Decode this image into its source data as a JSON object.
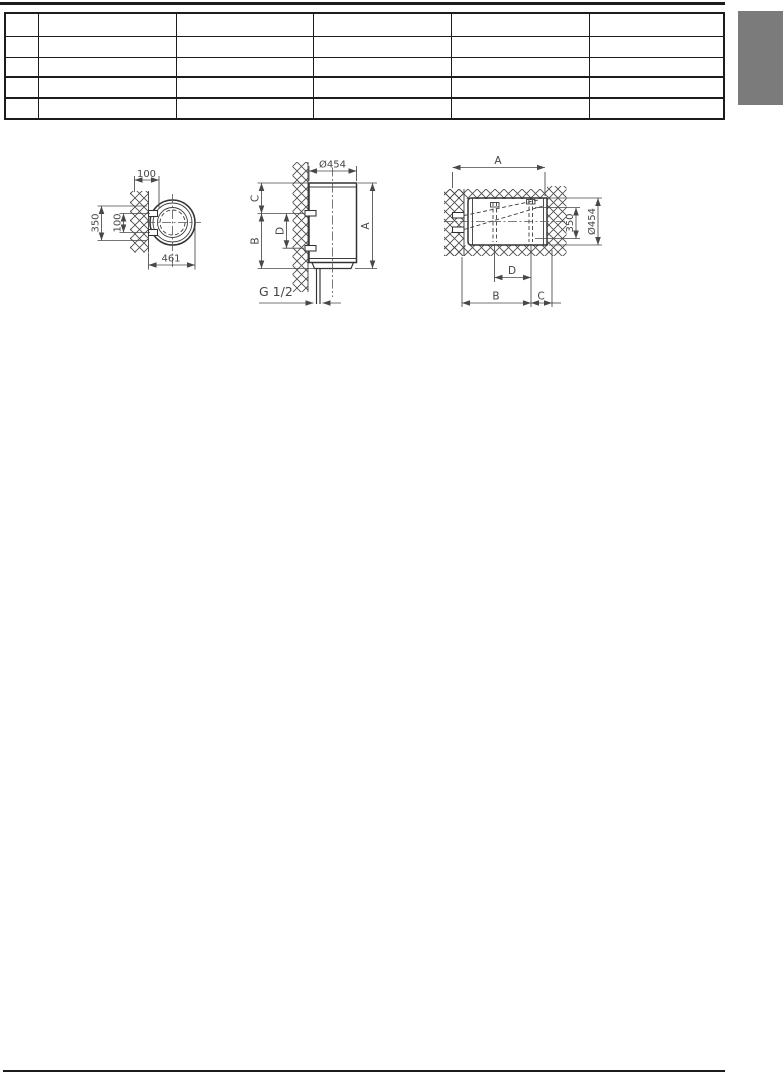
{
  "page": {
    "background": "#ffffff",
    "top_rule_color": "#1c1c1c",
    "bottom_rule_color": "#1c1c1c",
    "section_tab_color": "#7b7b7b"
  },
  "table": {
    "rows": 5,
    "cols": 6,
    "cells": [
      [
        "",
        "",
        "",
        "",
        "",
        ""
      ],
      [
        "",
        "",
        "",
        "",
        "",
        ""
      ],
      [
        "",
        "",
        "",
        "",
        "",
        ""
      ],
      [
        "",
        "",
        "",
        "",
        "",
        ""
      ],
      [
        "",
        "",
        "",
        "",
        "",
        ""
      ]
    ]
  },
  "drawings": {
    "top_view": {
      "dims": {
        "top": "100",
        "left_outer": "350",
        "left_inner": "100",
        "bottom": "461"
      }
    },
    "vertical_mount_view": {
      "dims": {
        "diameter_top": "Ø454",
        "height_right": "A",
        "left_top": "C",
        "left_bottom": "B",
        "left_inner": "D",
        "connection": "G 1/2"
      }
    },
    "horizontal_mount_view": {
      "dims": {
        "length_top": "A",
        "right_inner": "350",
        "right_outer": "Ø454",
        "bottom_inner": "D",
        "bottom_left": "B",
        "bottom_right": "C"
      }
    }
  }
}
